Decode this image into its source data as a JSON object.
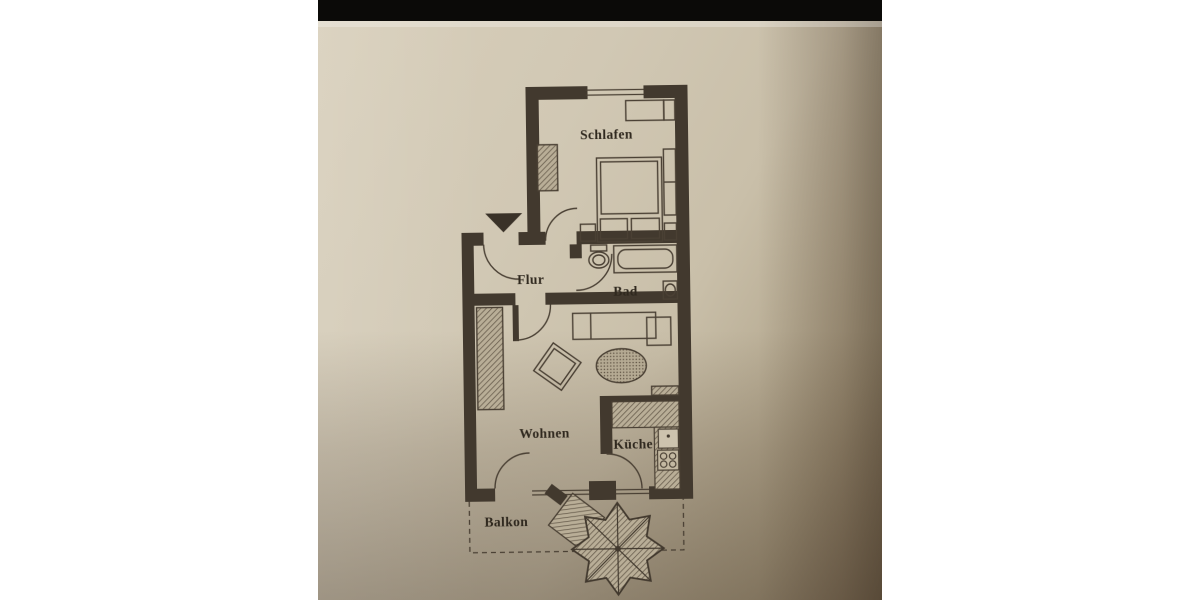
{
  "photo": {
    "type": "scanned floor plan photo",
    "top_bar_color": "#0b0a08",
    "paper_color": "#cfc5b1",
    "ink_color": "#42392e"
  },
  "floor_plan": {
    "rooms": [
      {
        "id": "schlafen",
        "label": "Schlafen"
      },
      {
        "id": "flur",
        "label": "Flur"
      },
      {
        "id": "bad",
        "label": "Bad"
      },
      {
        "id": "wohnen",
        "label": "Wohnen"
      },
      {
        "id": "kueche",
        "label": "Küche"
      },
      {
        "id": "balkon",
        "label": "Balkon"
      }
    ],
    "markers": [
      {
        "id": "entrance-arrow",
        "meaning": "apartment entrance direction"
      }
    ]
  }
}
